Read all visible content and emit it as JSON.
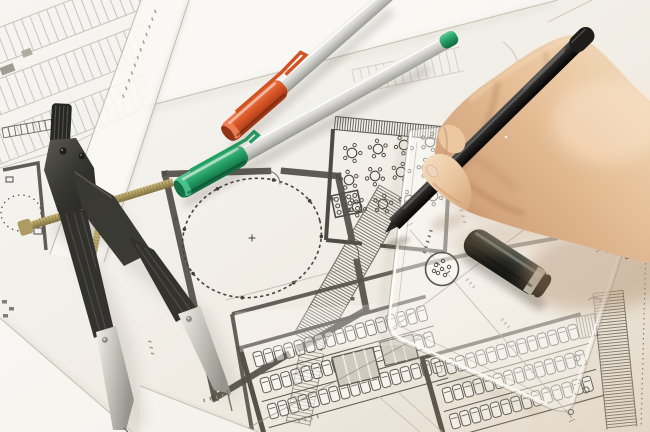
{
  "scene": {
    "type": "photograph",
    "description": "Close-up photo of an architect's workspace: a right hand holding a black fineliner pen draws on architectural floor plans; a black drafting compass with brass adjustment screw lies at left, two silver marker pens with orange and green caps rest on the drawings, and a transparent set-square with a round logo stamp and a loose black pen cap sit at lower right. The blueprints show a round hall with a dotted circle, a room full of round tables, hatched walls and rows of parking stalls. No legible text is visible; all annotations and dimension figures are blurred.",
    "objects": [
      {
        "id": "drafting-compass",
        "label": "drafting compass",
        "desc": "black compass with knurled grip, hinged head, brass threaded adjustment screw and two spread legs with silver tips"
      },
      {
        "id": "marker-pen-orange",
        "label": "orange-capped marker pen",
        "desc": "silver barrel pen with orange cap and clip lying across a paper edge"
      },
      {
        "id": "marker-pen-green",
        "label": "green-capped marker pen",
        "desc": "silver barrel pen with green cap and clip and green end plug"
      },
      {
        "id": "drawing-pen-black",
        "label": "black fineliner pen",
        "desc": "black pen held in the hand, tip touching a hatched wall on the plan"
      },
      {
        "id": "hand",
        "label": "drafting hand",
        "desc": "right hand gripping the black pen, wrist exiting at the right edge"
      },
      {
        "id": "set-square",
        "label": "transparent triangle ruler",
        "desc": "clear acrylic set-square with rounded corners and a circular logo stamp"
      },
      {
        "id": "pen-cap-black",
        "label": "black pen cap",
        "desc": "loose black cap with pale gray ring lying on the set-square"
      },
      {
        "id": "floor-plans",
        "label": "architectural drawings",
        "desc": "overlapping white sheets: site plan with parking rows, round hall with dotted circle, table layout, hatched walls, parking stalls, dimension lines with blurred figures"
      }
    ],
    "colors": {
      "paper_base": "#f3f1ec",
      "paper_bright": "#faf9f5",
      "paper_shadow": "#d8d3c8",
      "plan_ink": "#4a4840",
      "plan_mid": "#6b695e",
      "plan_faint": "#c5c2b6",
      "cap_orange": "#d14e1f",
      "cap_green": "#1d9e60",
      "barrel_silver": "#d9d9d6",
      "marker_black": "#141413",
      "cap_black": "#171c19",
      "cap_ring_gray": "#b7bcb0",
      "compass_dark": "#2e2e2a",
      "compass_silver": "#c9c9c2",
      "compass_brass": "#ab9a5e",
      "skin_light": "#f2d9ba",
      "skin_mid": "#e2b78d",
      "skin_shadow": "#b98a63",
      "ruler_edge": "#8d897a"
    }
  }
}
